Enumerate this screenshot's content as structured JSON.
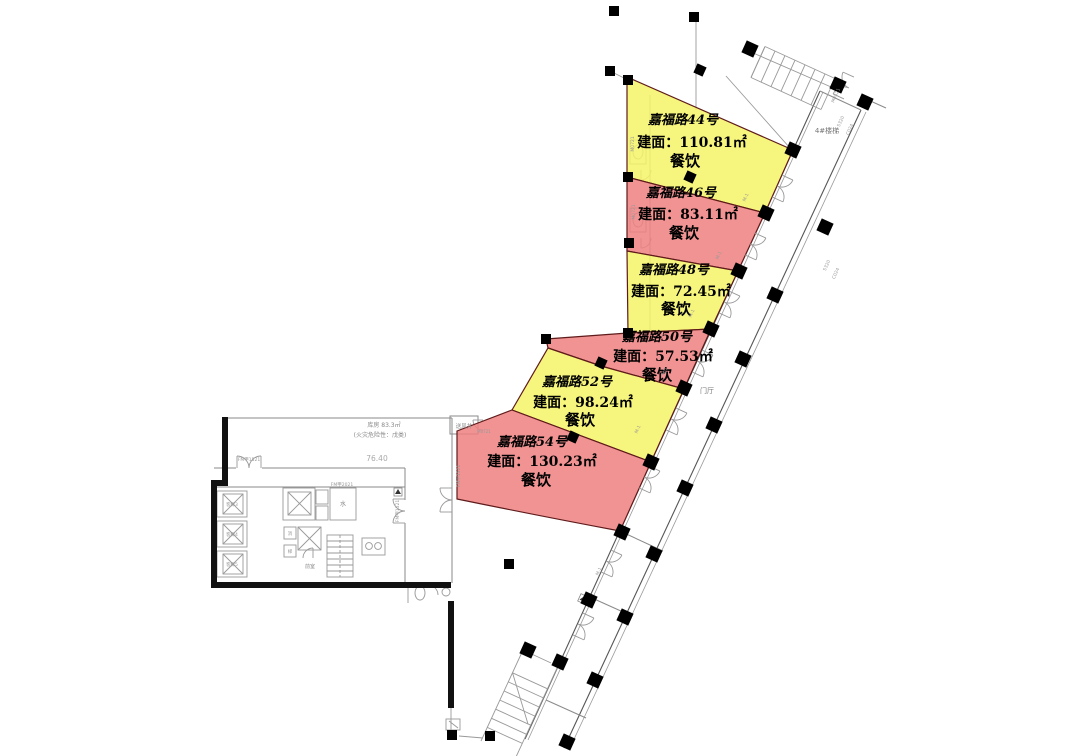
{
  "zones": [
    {
      "name": "嘉福路44号",
      "area": "建面：110.81㎡",
      "use": "餐饮",
      "color": "#f5f366"
    },
    {
      "name": "嘉福路46号",
      "area": "建面：83.11㎡",
      "use": "餐饮",
      "color": "#ef8080"
    },
    {
      "name": "嘉福路48号",
      "area": "建面：72.45㎡",
      "use": "餐饮",
      "color": "#f5f366"
    },
    {
      "name": "嘉福路50号",
      "area": "建面：57.53㎡",
      "use": "餐饮",
      "color": "#ef8080"
    },
    {
      "name": "嘉福路52号",
      "area": "建面：98.24㎡",
      "use": "餐饮",
      "color": "#f5f366"
    },
    {
      "name": "嘉福路54号",
      "area": "建面：130.23㎡",
      "use": "餐饮",
      "color": "#ef8080"
    }
  ],
  "rooms": {
    "storage": "库房 83.3㎡",
    "storage_note": "(火灾危险性：戊类)",
    "level_dim": "76.40",
    "stair4": "4#楼梯",
    "entrance_hall": "门厅",
    "air_shaft": "送风井",
    "water": "水",
    "front_room": "前室",
    "elevator_1": "客梯3",
    "elevator_2": "客梯4",
    "elevator_3": "客梯5",
    "fire_elevator": "消",
    "service_elevator": "梯"
  },
  "tags": {
    "fm1521": "FM甲1521",
    "fm2021": "FM甲2021",
    "m0721": "M0721",
    "m0521": "M0521",
    "w5320": "5320",
    "c024": "C024",
    "m1": "M-1"
  },
  "colors": {
    "zone_yellow": "#f5f366",
    "zone_red": "#ef8080",
    "column": "#000000",
    "wall": "#111111",
    "line": "#8a8a8a"
  }
}
